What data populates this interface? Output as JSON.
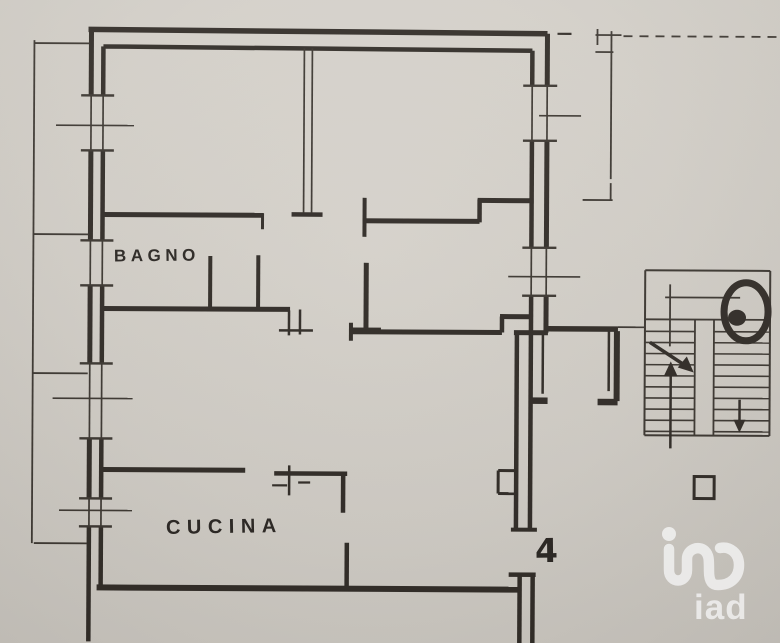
{
  "palette": {
    "paper": "#d3cfc8",
    "ink": "#332e29",
    "ink_thin": "#3e3933",
    "watermark": "rgba(255,255,255,0.8)"
  },
  "labels": {
    "bathroom": "BAGNO",
    "kitchen": "CUCINA",
    "unit_number": "4",
    "watermark": "iad"
  },
  "floorplan": {
    "walls": [
      [
        87,
        31,
        546,
        33,
        5.5
      ],
      [
        102,
        48,
        531,
        50,
        4.5
      ],
      [
        90,
        30,
        90,
        97,
        5
      ],
      [
        90,
        152,
        90,
        242,
        5
      ],
      [
        90,
        287,
        90,
        365,
        5
      ],
      [
        90,
        440,
        90,
        500,
        5
      ],
      [
        90,
        528,
        90,
        643,
        4.5
      ],
      [
        102,
        48,
        102,
        97,
        4.5
      ],
      [
        102,
        152,
        102,
        242,
        4.5
      ],
      [
        102,
        287,
        102,
        365,
        4.5
      ],
      [
        102,
        440,
        102,
        500,
        4.5
      ],
      [
        102,
        528,
        102,
        589,
        4.5
      ],
      [
        546,
        33,
        546,
        85,
        5
      ],
      [
        546,
        140,
        546,
        247,
        5
      ],
      [
        546,
        295,
        546,
        332,
        5
      ],
      [
        531,
        50,
        531,
        85,
        4.5
      ],
      [
        531,
        140,
        531,
        247,
        4.5
      ],
      [
        531,
        295,
        531,
        332,
        4.5
      ],
      [
        291,
        215,
        322,
        215,
        4.5
      ],
      [
        103,
        216,
        263,
        216,
        5
      ],
      [
        262,
        214,
        262,
        230,
        3
      ],
      [
        103,
        310,
        290,
        310,
        5
      ],
      [
        258,
        256,
        258,
        310,
        4
      ],
      [
        210,
        257,
        210,
        310,
        4
      ],
      [
        364,
        198,
        364,
        237,
        4
      ],
      [
        362,
        221,
        479,
        221,
        5
      ],
      [
        479,
        199,
        479,
        222,
        4.5
      ],
      [
        477,
        200,
        533,
        200,
        5
      ],
      [
        366,
        263,
        366,
        333,
        5
      ],
      [
        350,
        330,
        381,
        330,
        4.5
      ],
      [
        350,
        332,
        502,
        332,
        5
      ],
      [
        351,
        323,
        351,
        341,
        4
      ],
      [
        502,
        316,
        502,
        332,
        4.5
      ],
      [
        500,
        316,
        533,
        316,
        5
      ],
      [
        548,
        328,
        618,
        328,
        5.5
      ],
      [
        514,
        332,
        548,
        332,
        5
      ],
      [
        517,
        332,
        517,
        528,
        4.5
      ],
      [
        531,
        332,
        531,
        528,
        4.5
      ],
      [
        512,
        529,
        538,
        529,
        4
      ],
      [
        517,
        470,
        499,
        470,
        3
      ],
      [
        499,
        470,
        499,
        493,
        3
      ],
      [
        499,
        493,
        517,
        493,
        3
      ],
      [
        617,
        330,
        617,
        400,
        6
      ],
      [
        609,
        330,
        609,
        390,
        2.5
      ],
      [
        598,
        401,
        618,
        401,
        6.5
      ],
      [
        543,
        332,
        543,
        393,
        2.5
      ],
      [
        531,
        400,
        548,
        400,
        6.5
      ],
      [
        103,
        471,
        246,
        471,
        5
      ],
      [
        275,
        474,
        348,
        474,
        4.5
      ],
      [
        344,
        474,
        344,
        513,
        4.5
      ],
      [
        290,
        466,
        290,
        496,
        2.5
      ],
      [
        273,
        486,
        288,
        486,
        2.2
      ],
      [
        299,
        483,
        311,
        483,
        2.2
      ],
      [
        348,
        543,
        348,
        589,
        4.5
      ],
      [
        98,
        589,
        519,
        589,
        6
      ],
      [
        510,
        574,
        537,
        574,
        4.5
      ],
      [
        521,
        574,
        521,
        643,
        4.5
      ],
      [
        534,
        574,
        534,
        643,
        4.5
      ],
      [
        289,
        311,
        289,
        336,
        2.5
      ],
      [
        300,
        310,
        300,
        335,
        2.5
      ],
      [
        279,
        331,
        313,
        331,
        2.5
      ],
      [
        556,
        33,
        570,
        33,
        2.2
      ]
    ],
    "window_glass": [
      [
        90,
        97,
        90,
        152
      ],
      [
        102,
        97,
        102,
        152
      ],
      [
        90,
        242,
        90,
        287
      ],
      [
        102,
        242,
        102,
        287
      ],
      [
        90,
        365,
        90,
        440
      ],
      [
        102,
        365,
        102,
        440
      ],
      [
        90,
        500,
        90,
        528
      ],
      [
        102,
        500,
        102,
        528
      ],
      [
        531,
        85,
        531,
        140
      ],
      [
        546,
        85,
        546,
        140
      ],
      [
        531,
        247,
        531,
        295
      ],
      [
        546,
        247,
        546,
        295
      ],
      [
        303,
        49,
        303,
        213
      ],
      [
        311,
        49,
        311,
        213
      ]
    ],
    "window_ticks": [
      [
        80,
        97,
        113,
        97
      ],
      [
        80,
        152,
        113,
        152
      ],
      [
        80,
        242,
        113,
        242
      ],
      [
        80,
        287,
        113,
        287
      ],
      [
        80,
        365,
        113,
        365
      ],
      [
        80,
        440,
        113,
        440
      ],
      [
        80,
        500,
        113,
        500
      ],
      [
        80,
        528,
        113,
        528
      ],
      [
        522,
        85,
        556,
        85
      ],
      [
        522,
        140,
        556,
        140
      ],
      [
        522,
        247,
        556,
        247
      ],
      [
        522,
        295,
        556,
        295
      ]
    ],
    "sill_lines": [
      [
        55,
        127,
        133,
        127
      ],
      [
        53,
        400,
        133,
        400
      ],
      [
        60,
        512,
        133,
        512
      ],
      [
        538,
        115,
        580,
        115
      ],
      [
        508,
        276,
        580,
        276
      ]
    ],
    "balcony_lines": [
      [
        33,
        42,
        33,
        545
      ],
      [
        33,
        45,
        88,
        45
      ],
      [
        33,
        236,
        88,
        236
      ],
      [
        33,
        375,
        88,
        375
      ],
      [
        35,
        545,
        88,
        545
      ],
      [
        610,
        30,
        610,
        178
      ],
      [
        610,
        182,
        610,
        199
      ],
      [
        582,
        199,
        612,
        199
      ],
      [
        594,
        34,
        620,
        34
      ],
      [
        594,
        51,
        612,
        51
      ],
      [
        596,
        28,
        596,
        44
      ],
      [
        618,
        326,
        645,
        326
      ]
    ],
    "dashed_lines": [
      [
        622,
        35,
        777,
        35
      ]
    ],
    "stairs": {
      "outline": [
        [
          645,
          269,
          770,
          269
        ],
        [
          645,
          269,
          645,
          434
        ],
        [
          770,
          269,
          770,
          434
        ],
        [
          645,
          434,
          770,
          434
        ]
      ],
      "lines": [
        [
          665,
          296,
          740,
          296
        ],
        [
          646,
          318,
          770,
          318
        ],
        [
          670,
          283,
          670,
          345
        ],
        [
          695,
          318,
          695,
          434
        ],
        [
          714,
          318,
          714,
          434
        ]
      ],
      "flights": {
        "y_start": 330,
        "y_end": 430,
        "count": 10,
        "left": [
          645,
          695
        ],
        "right": [
          714,
          770
        ]
      }
    },
    "arrows": {
      "lines": [
        [
          650,
          341,
          690,
          367,
          3.5
        ],
        [
          671,
          447,
          671,
          368,
          2.5
        ],
        [
          740,
          398,
          740,
          426,
          2.5
        ]
      ],
      "heads": [
        [
          [
            694,
            371
          ],
          [
            678,
            366
          ],
          [
            687,
            355
          ]
        ],
        [
          [
            671,
            360
          ],
          [
            664,
            375
          ],
          [
            678,
            375
          ]
        ],
        [
          [
            740,
            431
          ],
          [
            734,
            418
          ],
          [
            746,
            418
          ]
        ]
      ]
    },
    "blob": {
      "cx": 746,
      "cy": 310,
      "rx": 22,
      "ry": 29,
      "stroke": 7,
      "inner_cx": 737,
      "inner_cy": 316,
      "inner_rx": 9,
      "inner_ry": 8
    },
    "landing_square": {
      "x": 695,
      "y": 475,
      "w": 20,
      "h": 22,
      "stroke": 3
    },
    "logo": {
      "dot": {
        "cx": 669,
        "cy": 534,
        "r": 7
      },
      "path": "M669,549 L669,570 C669,584 687,584 687,570 L687,559 C687,549 699,545 705,551 C709,555 709,559 709,571 C709,583 713,585 718,585 C731,585 739,577 739,565 C739,553 730,546 720,548",
      "stroke_width": 10.5
    }
  }
}
